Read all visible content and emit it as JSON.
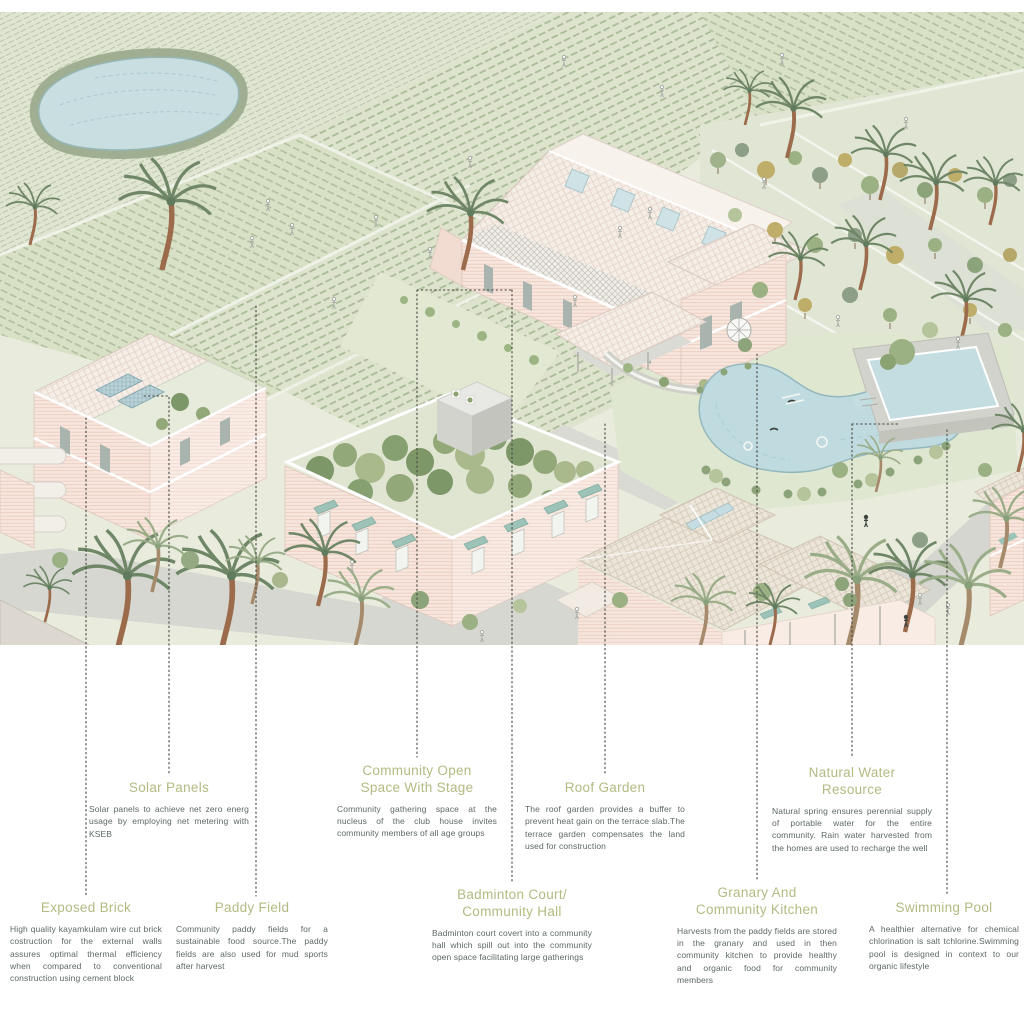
{
  "document": {
    "kind": "architectural site axonometric with annotations",
    "background": "#ffffff"
  },
  "colors": {
    "title_text": "#b4ba82",
    "body_text": "#5d6963",
    "leader_line": "#45463f",
    "pond_water": "#c9dee1",
    "pool_water": "#c0dbdf",
    "paddy_green": "#dde3cd",
    "brick_pink": "#f7e6dd",
    "roof_tile": "#f5eee7",
    "awning_teal": "#9dc3b8",
    "green_roof": "#8ba272",
    "palm_trunk": "#9b6b4c",
    "road_grey": "#d6d7d1"
  },
  "illustration": {
    "features": [
      "paddy-fields",
      "pond",
      "club-house-roof-skylights",
      "jali-lattice-screen",
      "spiral-staircase",
      "solar-panels",
      "green-roof-terrace",
      "swimming-pool",
      "natural-spring-pool",
      "granary-building",
      "palm-trees",
      "tree-grove",
      "roads",
      "people-figures"
    ]
  },
  "labels": [
    {
      "id": "solar-panels",
      "title": "Solar Panels",
      "body": "Solar panels to achieve net zero energ usage by employing net metering with KSEB"
    },
    {
      "id": "community-open-space",
      "title": "Community Open Space With Stage",
      "body": "Community gathering space at the nucleus of the club house invites community members of all age groups"
    },
    {
      "id": "roof-garden",
      "title": "Roof Garden",
      "body": "The roof garden provides a buffer to prevent heat gain on the terrace slab.The terrace garden compensates the land used for construction"
    },
    {
      "id": "natural-water-resource",
      "title": "Natural Water Resource",
      "body": "Natural spring ensures perennial supply of portable water for the entire community. Rain water harvested from the homes are used to recharge the well"
    },
    {
      "id": "exposed-brick",
      "title": "Exposed Brick",
      "body": "High quality kayamkulam wire cut brick costruction for the external walls assures optimal thermal efficiency when compared to conventional construction using cement block"
    },
    {
      "id": "paddy-field",
      "title": "Paddy Field",
      "body": "Community paddy fields for a sustainable food source.The paddy fields are also used for mud sports after harvest"
    },
    {
      "id": "badminton-court",
      "title": "Badminton Court/ Community Hall",
      "body": "Badminton court covert into a community hall which spill out into the community open space facilitating large gatherings"
    },
    {
      "id": "granary-community-kitchen",
      "title": "Granary And Community Kitchen",
      "body": "Harvests from the paddy fields are stored in the granary and used in then community kitchen to provide healthy and organic food for community members"
    },
    {
      "id": "swimming-pool",
      "title": "Swimming Pool",
      "body": "A healthier alternative for chemical chlorination is salt tchlorine.Swimming pool is designed in context to our organic lifestyle"
    }
  ]
}
